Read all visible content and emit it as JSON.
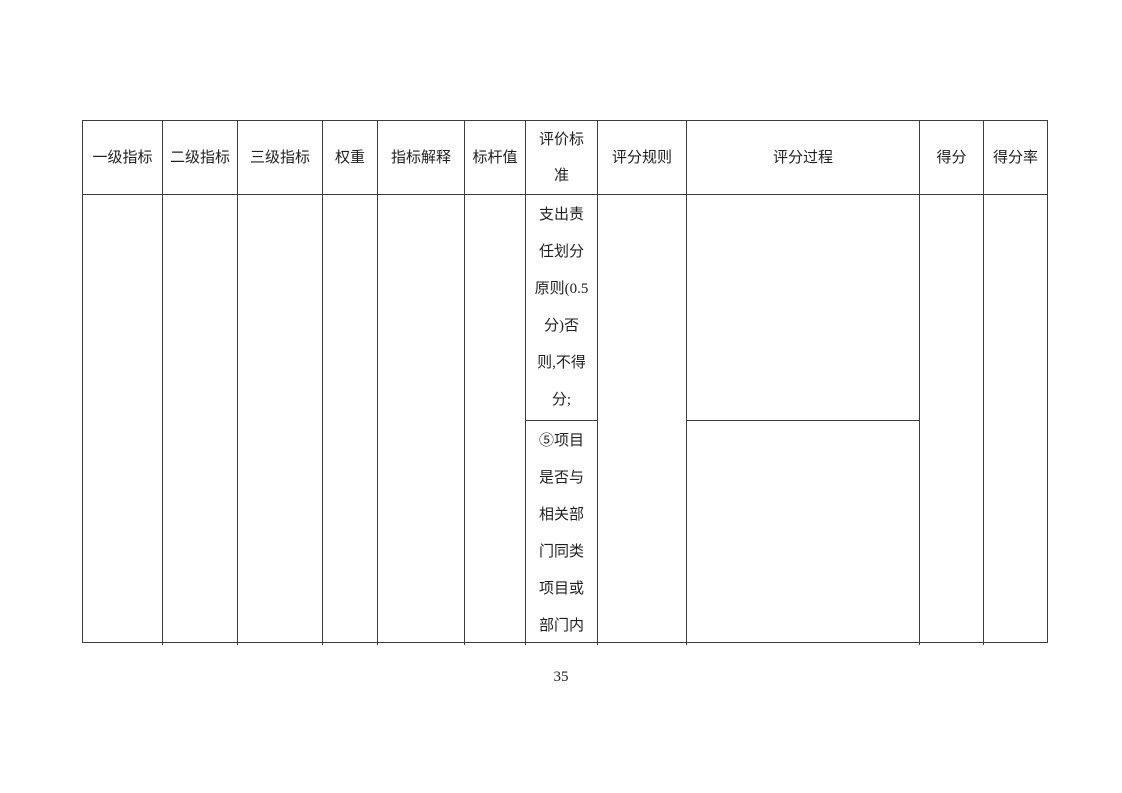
{
  "page": {
    "number": "35"
  },
  "colors": {
    "border": "#3d3d3d",
    "text": "#1f1f1f",
    "background": "#ffffff"
  },
  "table": {
    "headers": [
      "一级指标",
      "二级指标",
      "三级指标",
      "权重",
      "指标解释",
      "标杆值",
      "评价标\n准",
      "评分规则",
      "评分过程",
      "得分",
      "得分率"
    ],
    "body": {
      "evaluation_criteria": [
        "支出责\n任划分\n原则(0.5\n分)否\n则,不得\n分;",
        "⑤项目\n是否与\n相关部\n门同类\n项目或\n部门内"
      ]
    }
  }
}
